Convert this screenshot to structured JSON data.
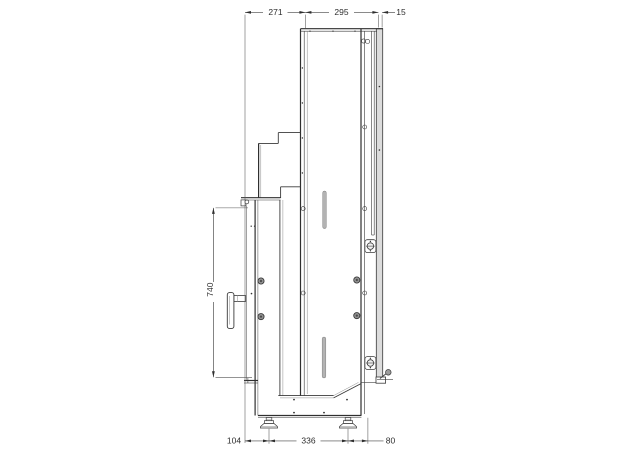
{
  "drawing": {
    "type": "machine-side-view-technical-drawing",
    "line_color": "#3a3a3a",
    "panel_fill": "#dcdcdc",
    "slot_fill": "#b3b3b3",
    "dimensions": {
      "top": [
        {
          "label": "271"
        },
        {
          "label": "295"
        },
        {
          "label": "15"
        }
      ],
      "left": [
        {
          "label": "740"
        }
      ],
      "bottom": [
        {
          "label": "104"
        },
        {
          "label": "336"
        },
        {
          "label": "80"
        }
      ]
    }
  }
}
